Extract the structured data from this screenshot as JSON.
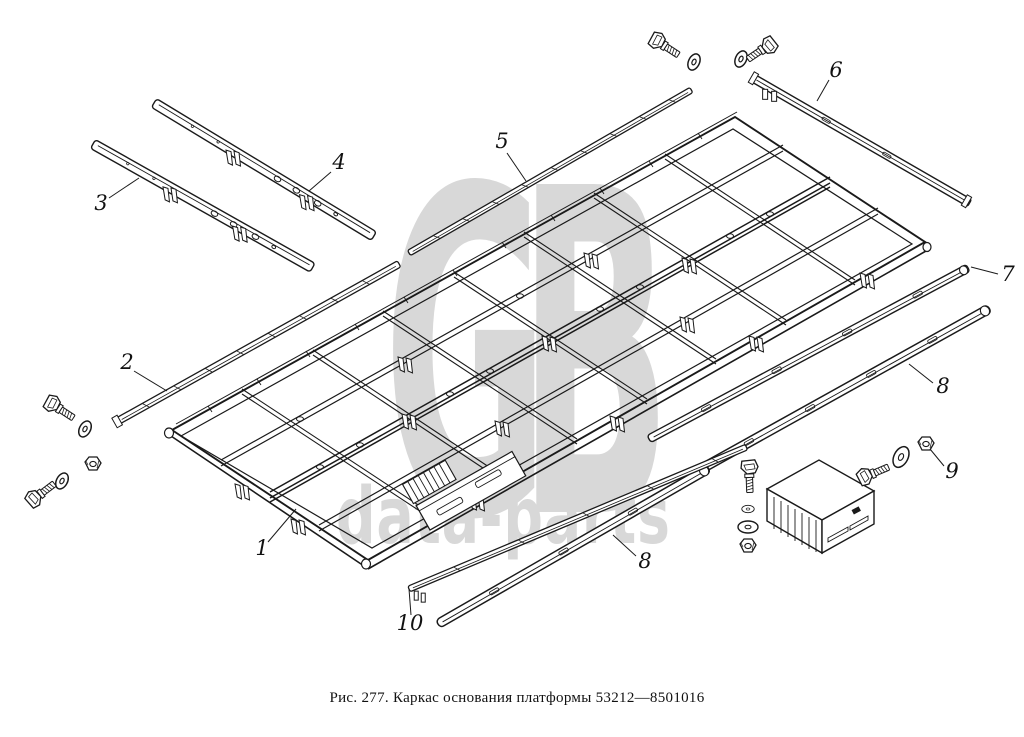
{
  "figure": {
    "caption": "Рис. 277. Каркас основания платформы 53212—8501016",
    "figure_label": "Рис. 277.",
    "title": "Каркас основания платформы",
    "part_number": "53212—8501016"
  },
  "watermark": {
    "monogram": "GB",
    "wordmark": "data-parts",
    "color": "#d8d8d8"
  },
  "callouts": [
    "1",
    "2",
    "3",
    "4",
    "5",
    "6",
    "7",
    "8",
    "8",
    "9",
    "10"
  ],
  "colors": {
    "ink": "#1a1a1a",
    "paper": "#ffffff",
    "watermark": "#d8d8d8"
  }
}
